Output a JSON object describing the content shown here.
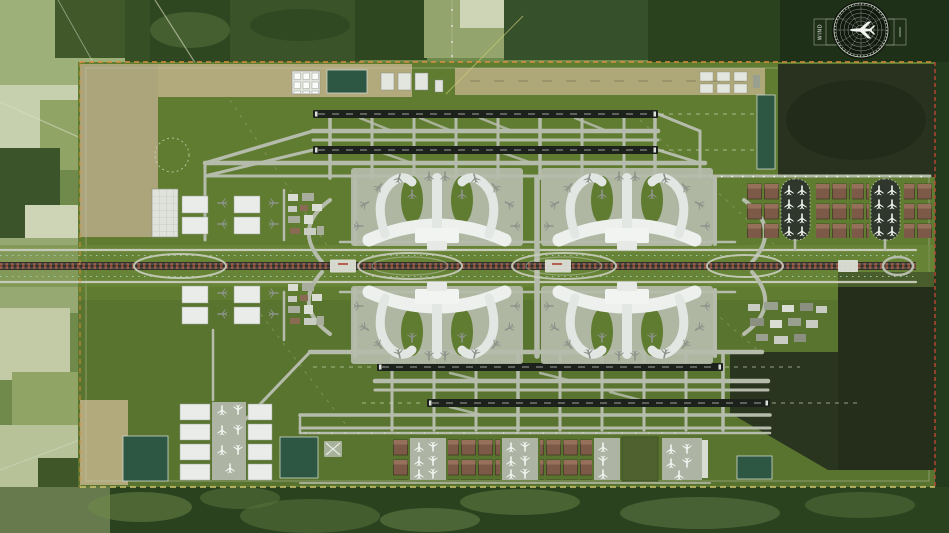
{
  "meta": {
    "description": "Aerial rendering of a four-runway airport master plan surrounded by farmland and forest"
  },
  "wind_rose": {
    "label": "WIND"
  },
  "features": {
    "runway_count": 4,
    "terminal_count": 4,
    "satellite_concourse_count": 2,
    "retention_ponds": 5
  },
  "colors": {
    "terrain_base": "#6f8a4a",
    "forest_dark": "#31481f",
    "field_light": "#9db07a",
    "field_pale": "#cbd3b0",
    "site_grass": "#5f7c31",
    "strip_tan": "#b2aa7c",
    "pavement": "#b6bcab",
    "pavement_light": "#c9cdbd",
    "runway_dark": "#1d211c",
    "terminal_white": "#e9ece9",
    "building_brown": "#7d5a47",
    "pond_green": "#2e5743",
    "rail_brown": "#8a4a38",
    "reserved_dark": "#28321f",
    "apron_dark": "#2f362c",
    "aircraft_white": "#f2f4f0",
    "aircraft_gray": "#8d938b",
    "boundary_orange": "#d98f3f",
    "boundary_yellow": "#d2c66f",
    "boundary_red": "#bf4734",
    "tree_dots": "#a9d6bf",
    "wind_rose_lines": "#c6ccc0"
  }
}
